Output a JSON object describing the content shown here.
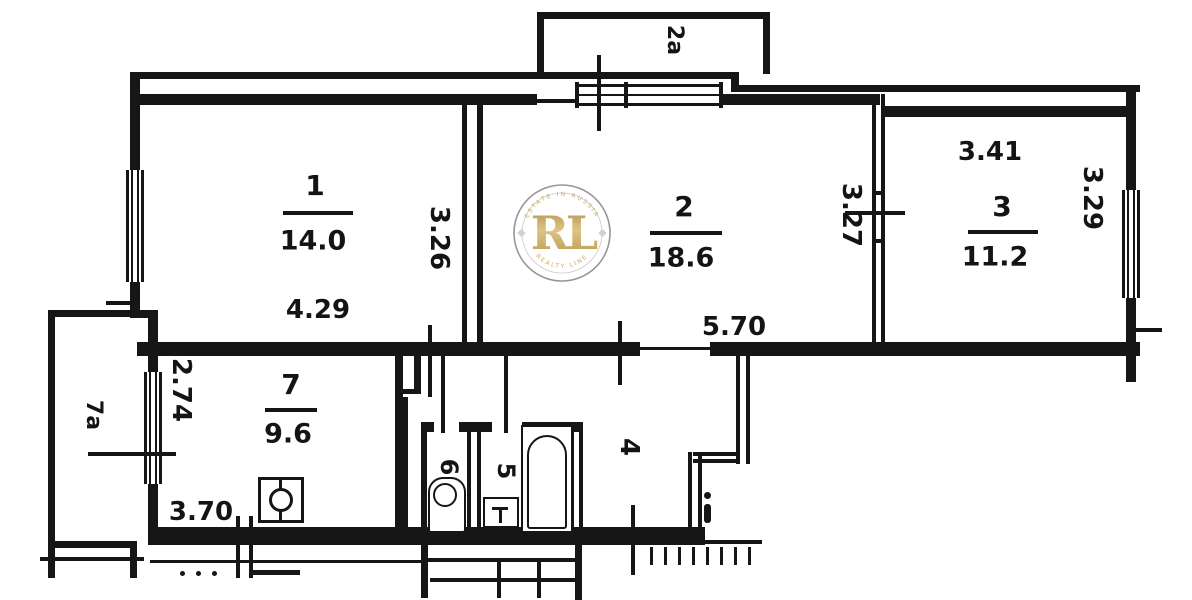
{
  "rooms": [
    {
      "number": "1",
      "area": "14.0",
      "width_label": "4.29",
      "depth_label": "3.26"
    },
    {
      "number": "2",
      "area": "18.6",
      "width_label": "5.70",
      "depth_label": "3.27"
    },
    {
      "number": "3",
      "area": "11.2",
      "width_label": "3.41",
      "depth_label": "3.29"
    },
    {
      "number": "7",
      "area": "9.6",
      "width_label": "3.70",
      "depth_label": "2.74"
    },
    {
      "number": "4"
    },
    {
      "number": "5"
    },
    {
      "number": "6"
    }
  ],
  "balconies": [
    {
      "label": "2a"
    },
    {
      "label": "7a"
    }
  ],
  "watermark": {
    "initials": "RL",
    "arc_top": "ESTATE IN RUSSIA",
    "arc_bottom": "REALTY LINE"
  },
  "colors": {
    "ink": "#161616",
    "paper": "#ffffff",
    "gold": "#bf9c4a",
    "ring": "#8f8f8f"
  }
}
